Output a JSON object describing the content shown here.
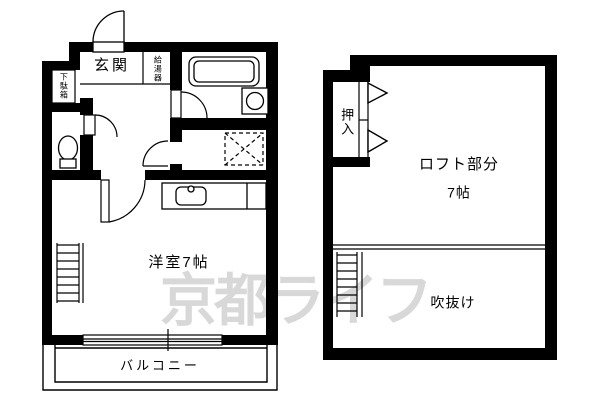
{
  "colors": {
    "wall": "#000000",
    "background": "#ffffff",
    "watermark_gray": "#d8d8d8"
  },
  "watermark": {
    "text": "京都ライフ"
  },
  "floor1": {
    "labels": {
      "genkan": "玄関",
      "water_heater": "給湯器",
      "shoe_cabinet": "下駄箱",
      "room": "洋室7帖",
      "balcony": "バルコニー"
    }
  },
  "floor2": {
    "labels": {
      "closet": "押入",
      "loft": "ロフト部分",
      "loft_size": "7帖",
      "void": "吹抜け"
    }
  }
}
